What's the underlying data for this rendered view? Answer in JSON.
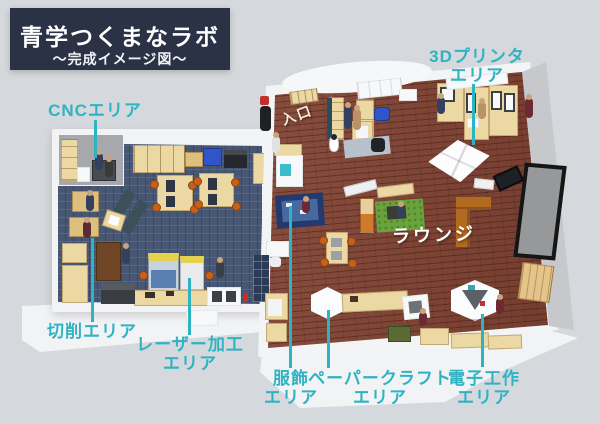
{
  "title": {
    "main": "青学つくまなラボ",
    "subtitle": "〜完成イメージ図〜"
  },
  "labels": {
    "cnc": "CNCエリア",
    "printer3d_l1": "3Dプリンタ",
    "printer3d_l2": "エリア",
    "cutting": "切削エリア",
    "laser_l1": "レーザー加工",
    "laser_l2": "エリア",
    "clothing_l1": "服飾",
    "clothing_l2": "エリア",
    "papercraft_l1": "ペーパークラフト",
    "papercraft_l2": "エリア",
    "electronics_l1": "電子工作",
    "electronics_l2": "エリア",
    "lounge": "ラウンジ",
    "entrance": "入口"
  },
  "colors": {
    "background": "#d5d8dc",
    "title_box": "#2b3246",
    "accent_teal": "#2fb3c2",
    "left_room_floor": "#475672",
    "right_room_floor": "#824434",
    "walls": "#f3f4f6",
    "grass_rug": "#6aa33c"
  }
}
